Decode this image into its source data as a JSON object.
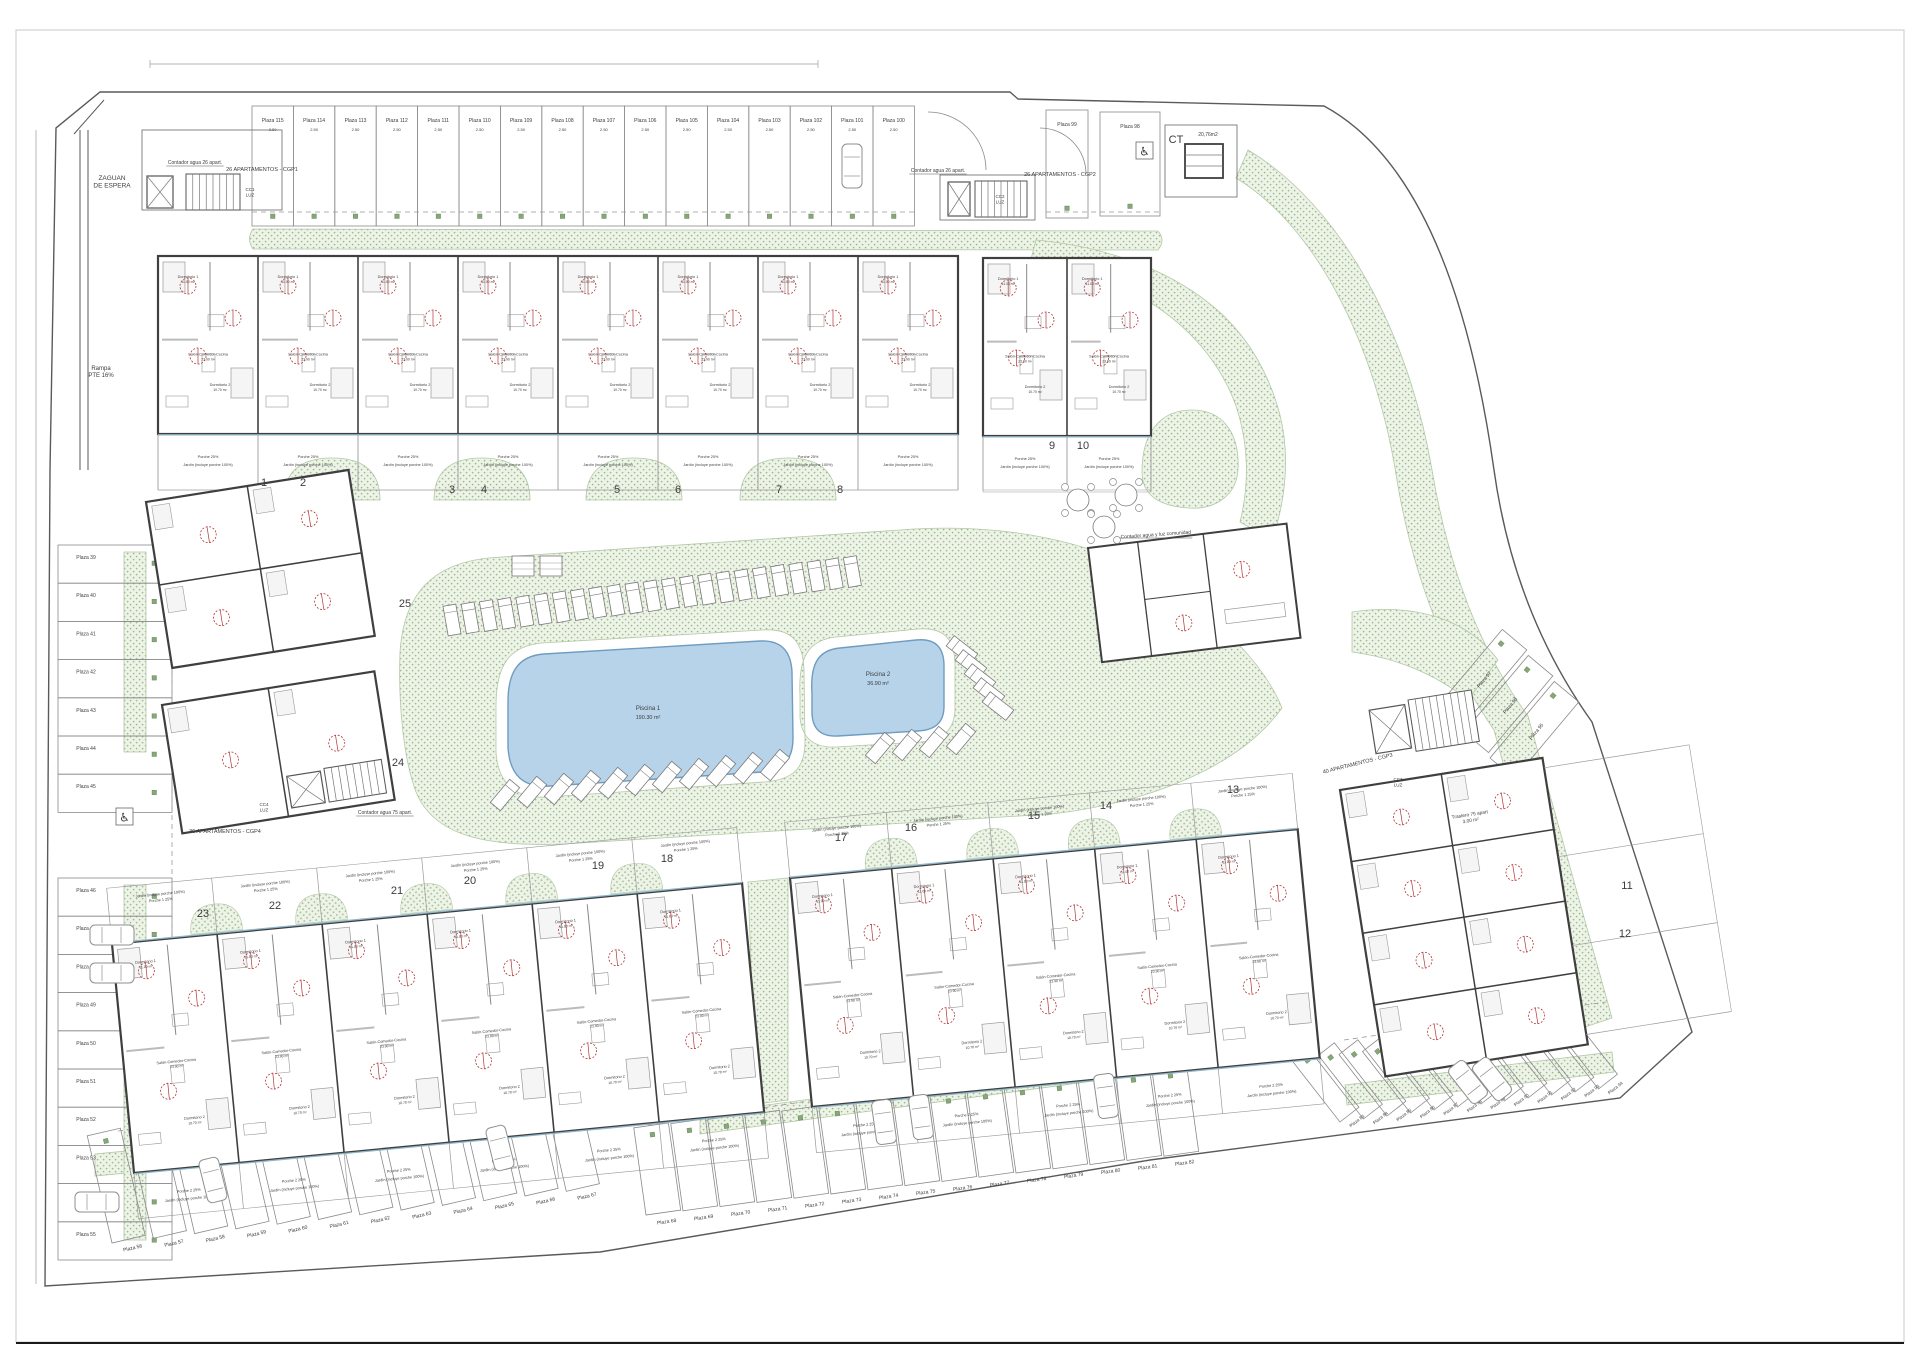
{
  "sheet": {
    "type": "architectural-site-plan",
    "bottom_border": true
  },
  "colors": {
    "paper": "#ffffff",
    "boundary": "#5a5a5a",
    "wall": "#3f3f3f",
    "thin_line": "#8a8a8a",
    "green_fill": "#eef3e8",
    "green_dot": "#9dbb8d",
    "green_edge": "#b2c9a6",
    "pool_fill": "#b7d3ea",
    "pool_edge": "#6f9cc0",
    "red_mark": "#b23434",
    "window_line": "#8fb6c9",
    "text": "#3c3c3c",
    "plot_number": "#5a5a5a",
    "marker_green": "#86a877"
  },
  "pools": [
    {
      "id": "pool-1",
      "name": "Piscina 1",
      "area": "190.30 m²"
    },
    {
      "id": "pool-2",
      "name": "Piscina 2",
      "area": "36.90 m²"
    }
  ],
  "parking": {
    "prefix": "Plaza ",
    "stall_dim": "2.50",
    "rows": [
      {
        "id": "top",
        "numbers": [
          115,
          114,
          113,
          112,
          111,
          110,
          109,
          108,
          107,
          106,
          105,
          104,
          103,
          102,
          101,
          100
        ]
      },
      {
        "id": "top99",
        "numbers": [
          99
        ]
      },
      {
        "id": "top98",
        "numbers": [
          98
        ],
        "accessible": true
      },
      {
        "id": "leftA",
        "numbers": [
          39,
          40,
          41,
          42,
          43,
          44,
          45
        ],
        "accessible_near": 45
      },
      {
        "id": "leftB",
        "numbers": [
          46,
          47,
          48,
          49,
          50,
          51,
          52,
          53,
          54,
          55
        ]
      },
      {
        "id": "bleft",
        "numbers": [
          56,
          57,
          58,
          59,
          60,
          61,
          62,
          63,
          64,
          65,
          66,
          67
        ]
      },
      {
        "id": "bmid",
        "numbers": [
          68,
          69,
          70,
          71,
          72,
          73,
          74,
          75,
          76,
          77,
          78,
          79,
          80,
          81,
          82
        ]
      },
      {
        "id": "bright",
        "numbers": [
          83,
          84,
          85,
          86,
          87,
          88,
          89,
          90,
          91,
          92,
          93,
          94
        ]
      },
      {
        "id": "rdiag",
        "numbers": [
          97,
          96,
          95
        ]
      }
    ]
  },
  "plots": [
    {
      "n": "1",
      "x": 264,
      "y": 486
    },
    {
      "n": "2",
      "x": 303,
      "y": 486
    },
    {
      "n": "3",
      "x": 452,
      "y": 493
    },
    {
      "n": "4",
      "x": 484,
      "y": 493
    },
    {
      "n": "5",
      "x": 617,
      "y": 493
    },
    {
      "n": "6",
      "x": 678,
      "y": 493
    },
    {
      "n": "7",
      "x": 779,
      "y": 493
    },
    {
      "n": "8",
      "x": 840,
      "y": 493
    },
    {
      "n": "9",
      "x": 1052,
      "y": 449
    },
    {
      "n": "10",
      "x": 1083,
      "y": 449
    },
    {
      "n": "11",
      "x": 1627,
      "y": 889
    },
    {
      "n": "12",
      "x": 1625,
      "y": 937
    },
    {
      "n": "13",
      "x": 1233,
      "y": 793
    },
    {
      "n": "14",
      "x": 1106,
      "y": 809
    },
    {
      "n": "15",
      "x": 1034,
      "y": 819
    },
    {
      "n": "16",
      "x": 911,
      "y": 831
    },
    {
      "n": "17",
      "x": 841,
      "y": 841
    },
    {
      "n": "18",
      "x": 667,
      "y": 862
    },
    {
      "n": "19",
      "x": 598,
      "y": 869
    },
    {
      "n": "20",
      "x": 470,
      "y": 884
    },
    {
      "n": "21",
      "x": 397,
      "y": 894
    },
    {
      "n": "22",
      "x": 275,
      "y": 909
    },
    {
      "n": "23",
      "x": 203,
      "y": 917
    },
    {
      "n": "24",
      "x": 398,
      "y": 766
    },
    {
      "n": "25",
      "x": 405,
      "y": 607
    }
  ],
  "unit_rooms": {
    "d1": "Dormitorio 1",
    "d1_area": "11.00 m²",
    "d2": "Dormitorio 2",
    "d2_area": "10.70 m²",
    "d3": "Dormitorio 3",
    "d3_area": "8.00 m²",
    "salon": "Salón-Comedor-Cocina",
    "salon_area": "23.90 m²",
    "b1": "Baño 1",
    "b1_area": "3.90 m²",
    "b2": "Baño 2",
    "b2_area": "3.60 m²",
    "paso": "Paso",
    "paso_area": "4.60 m²"
  },
  "garden_labels": {
    "porche_n": "Porche 25%",
    "porche_s1": "Porche 1 25%",
    "porche_s2": "Porche 2 25%",
    "jardin": "Jardín (incluye porche 100%)"
  },
  "annotations": [
    {
      "id": "zaguan",
      "text": "ZAGUAN\nDE ESPERA",
      "x": 112,
      "y": 180,
      "size": 6.5
    },
    {
      "id": "rampa",
      "text": "Rampa\nPTE 16%",
      "x": 101,
      "y": 370,
      "size": 6
    },
    {
      "id": "contador26a",
      "text": "Contador agua 26 apart.",
      "x": 195,
      "y": 164,
      "size": 5,
      "underline": true
    },
    {
      "id": "cgp1",
      "text": "26 APARTAMENTOS - CGP1",
      "x": 262,
      "y": 171,
      "size": 5.5
    },
    {
      "id": "cc1",
      "text": "CC1\nLUZ",
      "x": 250,
      "y": 191,
      "size": 4.5
    },
    {
      "id": "contador26b",
      "text": "Contador agua 26 apart.",
      "x": 938,
      "y": 172,
      "size": 5,
      "underline": true
    },
    {
      "id": "cgp2",
      "text": "26 APARTAMENTOS - CGP2",
      "x": 1060,
      "y": 176,
      "size": 5.5
    },
    {
      "id": "cc2",
      "text": "CC2\nLUZ",
      "x": 1000,
      "y": 198,
      "size": 4.5
    },
    {
      "id": "ct",
      "text": "CT",
      "x": 1176,
      "y": 143,
      "size": 11
    },
    {
      "id": "ct_area",
      "text": "20,76m2",
      "x": 1208,
      "y": 136,
      "size": 5
    },
    {
      "id": "comunidad",
      "text": "Contador agua y luz comunidad",
      "x": 1156,
      "y": 536,
      "size": 5,
      "rot": -4,
      "underline": true
    },
    {
      "id": "contador75",
      "text": "Contador agua 75 apart.",
      "x": 385,
      "y": 814,
      "size": 5,
      "underline": true
    },
    {
      "id": "cgp4",
      "text": "36 APARTAMENTOS - CGP4",
      "x": 225,
      "y": 833,
      "size": 5.5
    },
    {
      "id": "cc4",
      "text": "CC4\nLUZ",
      "x": 264,
      "y": 806,
      "size": 4.5
    },
    {
      "id": "cgp3",
      "text": "40 APARTAMENTOS - CGP3",
      "x": 1358,
      "y": 765,
      "size": 5.5,
      "rot": -14
    },
    {
      "id": "cc3",
      "text": "CC3\nLUZ",
      "x": 1398,
      "y": 781,
      "size": 4.5
    },
    {
      "id": "trastero",
      "text": "Trastero 75 apart\n3.00 m²",
      "x": 1470,
      "y": 816,
      "size": 4.8,
      "rot": -9
    }
  ],
  "icons": {
    "accessible": "♿"
  }
}
